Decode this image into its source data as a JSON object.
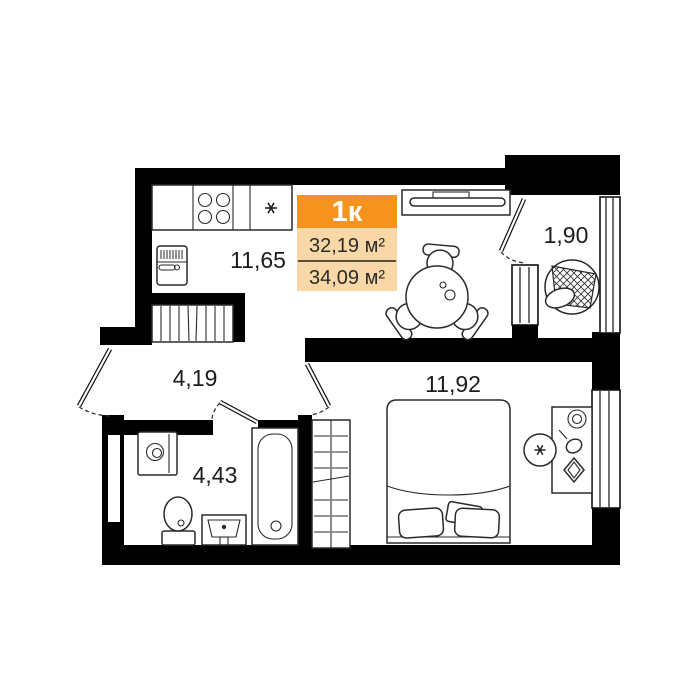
{
  "apartment": {
    "type_label": "1к",
    "living_area": "32,19 м²",
    "total_area": "34,09 м²",
    "colors": {
      "header_bg": "#F6921E",
      "header_text": "#FFFFFF",
      "area_rows_bg": "#F9D7A7",
      "walls": "#000000",
      "label_text": "#1C1C1C"
    },
    "rooms": {
      "kitchen_living": {
        "area": "11,65"
      },
      "balcony": {
        "area": "1,90"
      },
      "hallway": {
        "area": "4,19"
      },
      "bathroom": {
        "area": "4,43"
      },
      "bedroom": {
        "area": "11,92"
      }
    }
  }
}
